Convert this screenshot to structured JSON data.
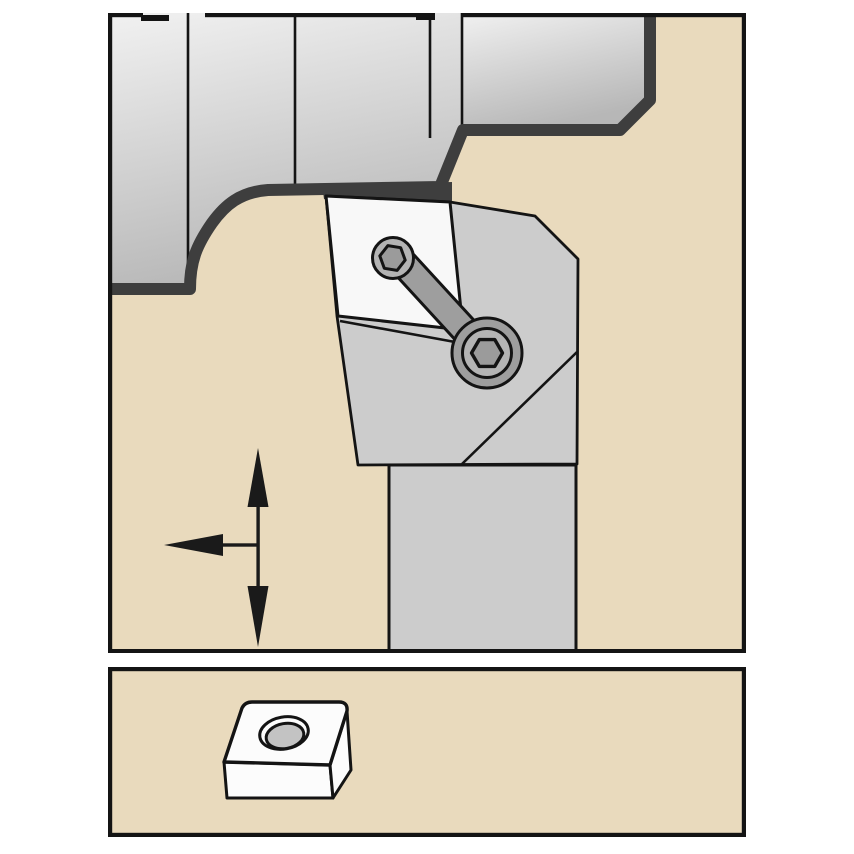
{
  "illustration": {
    "type": "machining-tool-holder-diagram",
    "top_panel": "tool holder with clamped insert turning a stepped workpiece shoulder, feed direction arrows",
    "bottom_panel": "indexable insert with center hole"
  },
  "colors": {
    "page_background": "#ffffff",
    "panel_background": "#e9dabd",
    "frame": "#141414",
    "outline": "#141414",
    "profile_band": "#3e3e3e",
    "workpiece_light": "#f1f1f1",
    "workpiece_dark": "#b7b7b7",
    "holder_body": "#cccccc",
    "clamp_arm": "#9e9e9e",
    "screw_face": "#b4b4b4",
    "screw_hex": "#9b9b9b",
    "insert_face": "#f8f8f8",
    "insert_bottom_face": "#fcfcfc",
    "insert_hole": "#c3c3c3",
    "arrow": "#1a1a1a"
  },
  "icons": {
    "feed_arrows": "feed-direction-arrows-icon",
    "hex_socket": "hex-socket-icon"
  }
}
